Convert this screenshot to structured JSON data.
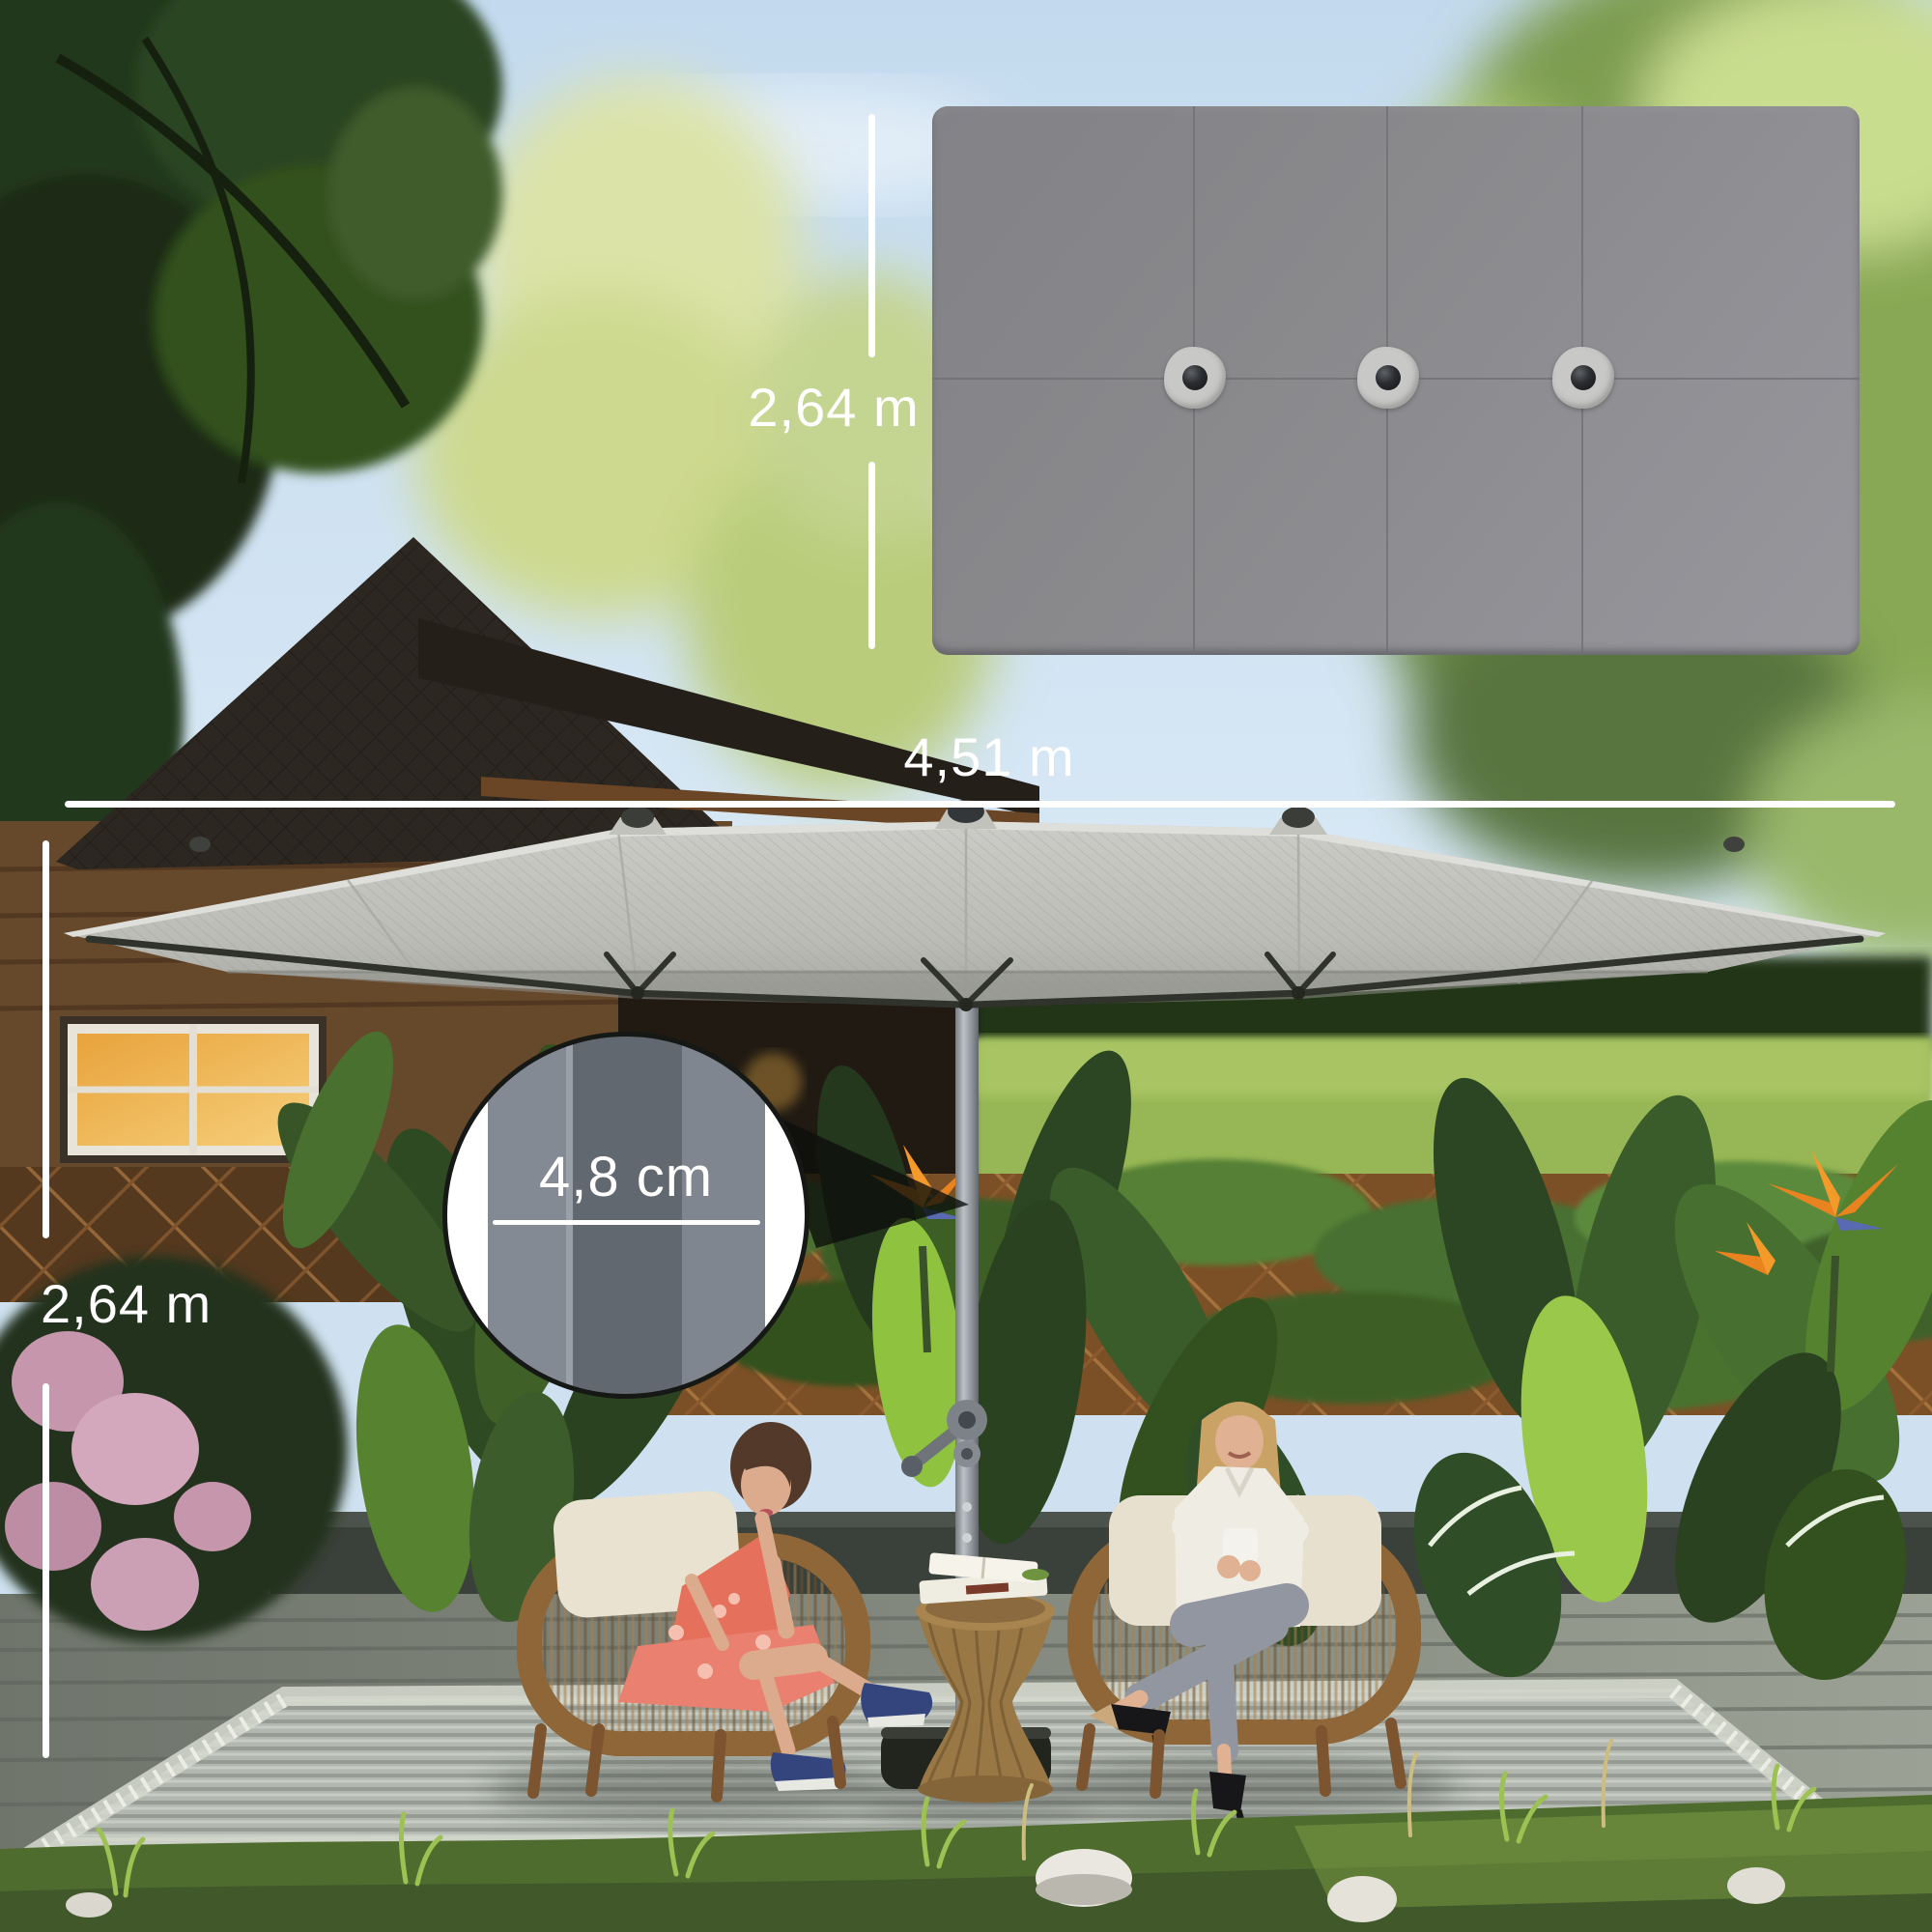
{
  "labels": {
    "top_view_depth": "2,64 m",
    "width": "4,51 m",
    "height": "2,64 m",
    "pole_diameter": "4,8 cm"
  },
  "top_view": {
    "vent_button_count": 3
  },
  "colors": {
    "dimension_text": "#ffffff",
    "dimension_line": "#ffffff",
    "canopy_top_view_gray": "#8c8c8e",
    "canopy_photo_gray": "#c1c1bc",
    "pole_silver": "#9aa0a5",
    "inset_border": "#161816",
    "inset_pole_dark": "#62686f",
    "inset_pole_light": "#848a93"
  }
}
